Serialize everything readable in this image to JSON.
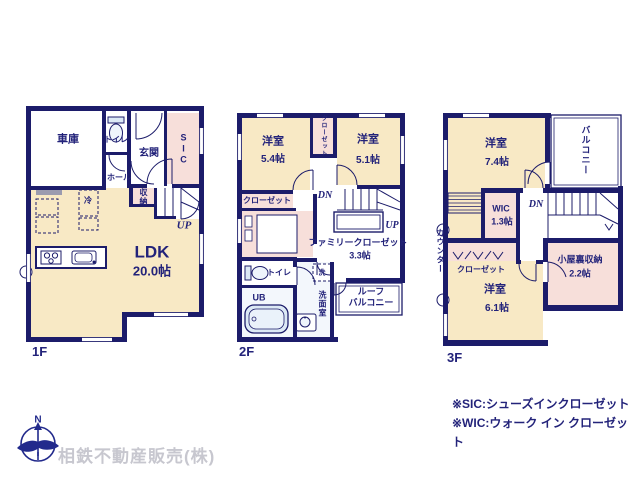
{
  "colors": {
    "wall": "#1c1c6a",
    "floor_cream": "#f8e9c5",
    "room_pink": "#f7dfda",
    "text_navy": "#23237a",
    "fixture_blue": "#dce9f5",
    "company_gray": "#c7c7cf"
  },
  "floor1": {
    "label": "1F",
    "garage": "車庫",
    "toilet": "トイレ",
    "entrance": "玄関",
    "sic": "SIC",
    "hall": "ホール",
    "fridge": "冷",
    "storage": "収納",
    "up": "UP",
    "ldk": "LDK",
    "ldk_size": "20.0帖"
  },
  "floor2": {
    "label": "2F",
    "room1": "洋室",
    "room1_size": "5.4帖",
    "closet_top": "クローゼット",
    "room2": "洋室",
    "room2_size": "5.1帖",
    "closet_left": "クローゼット",
    "dn": "DN",
    "up": "UP",
    "family_closet": "ファミリークローゼット",
    "family_closet_size": "3.3帖",
    "toilet": "トイレ",
    "washer": "洗",
    "ub": "UB",
    "washroom": "洗面室",
    "roof_balcony_1": "ルーフ",
    "roof_balcony_2": "バルコニー"
  },
  "floor3": {
    "label": "3F",
    "room1": "洋室",
    "room1_size": "7.4帖",
    "balcony": "バルコニー",
    "wic": "WIC",
    "wic_size": "1.3帖",
    "dn": "DN",
    "counter": "カウンター",
    "closet": "クローゼット",
    "attic": "小屋裏収納",
    "attic_size": "2.2帖",
    "room2": "洋室",
    "room2_size": "6.1帖"
  },
  "legend": {
    "sic_note": "※SIC:シューズインクローゼット",
    "wic_note": "※WIC:ウォーク イン クローゼット"
  },
  "footer": {
    "company": "相鉄不動産販売(株)",
    "compass_north": "N"
  }
}
